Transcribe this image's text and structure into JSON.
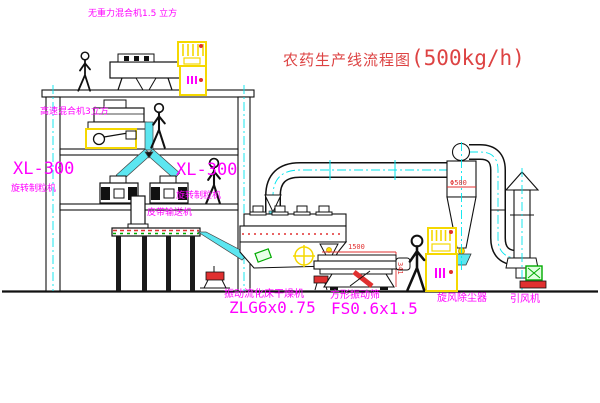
{
  "title": {
    "text": "农药生产线流程图",
    "capacity": "(500kg/h)"
  },
  "equipment": {
    "gravity_mixer": {
      "label": "无重力混合机1.5 立方"
    },
    "high_speed_mixer": {
      "label": "高速混合机3立方"
    },
    "granulator_left": {
      "model": "XL-300",
      "name": "旋转制粒机"
    },
    "granulator_right": {
      "model": "XL-300",
      "name": "旋转制粒机"
    },
    "belt_conveyor": {
      "label": "皮带输送机"
    },
    "fluid_bed_dryer": {
      "name": "振动流化床干燥机",
      "model": "ZLG6x0.75"
    },
    "vibrating_screen": {
      "name": "方形振动筛",
      "model": "FS0.6x1.5"
    },
    "cyclone": {
      "label": "旋风除尘器"
    },
    "fan": {
      "label": "引风机"
    }
  },
  "dimensions": {
    "screen_length": "1500",
    "screen_height": "341",
    "cyclone_dia": "Φ500"
  },
  "colors": {
    "label_magenta": "#ff00ff",
    "title_red": "#dd4343",
    "line_black": "#111111",
    "accent_cyan": "#00e5ee",
    "accent_yellow": "#f5d800",
    "accent_red": "#e03030",
    "accent_green": "#00aa00"
  }
}
